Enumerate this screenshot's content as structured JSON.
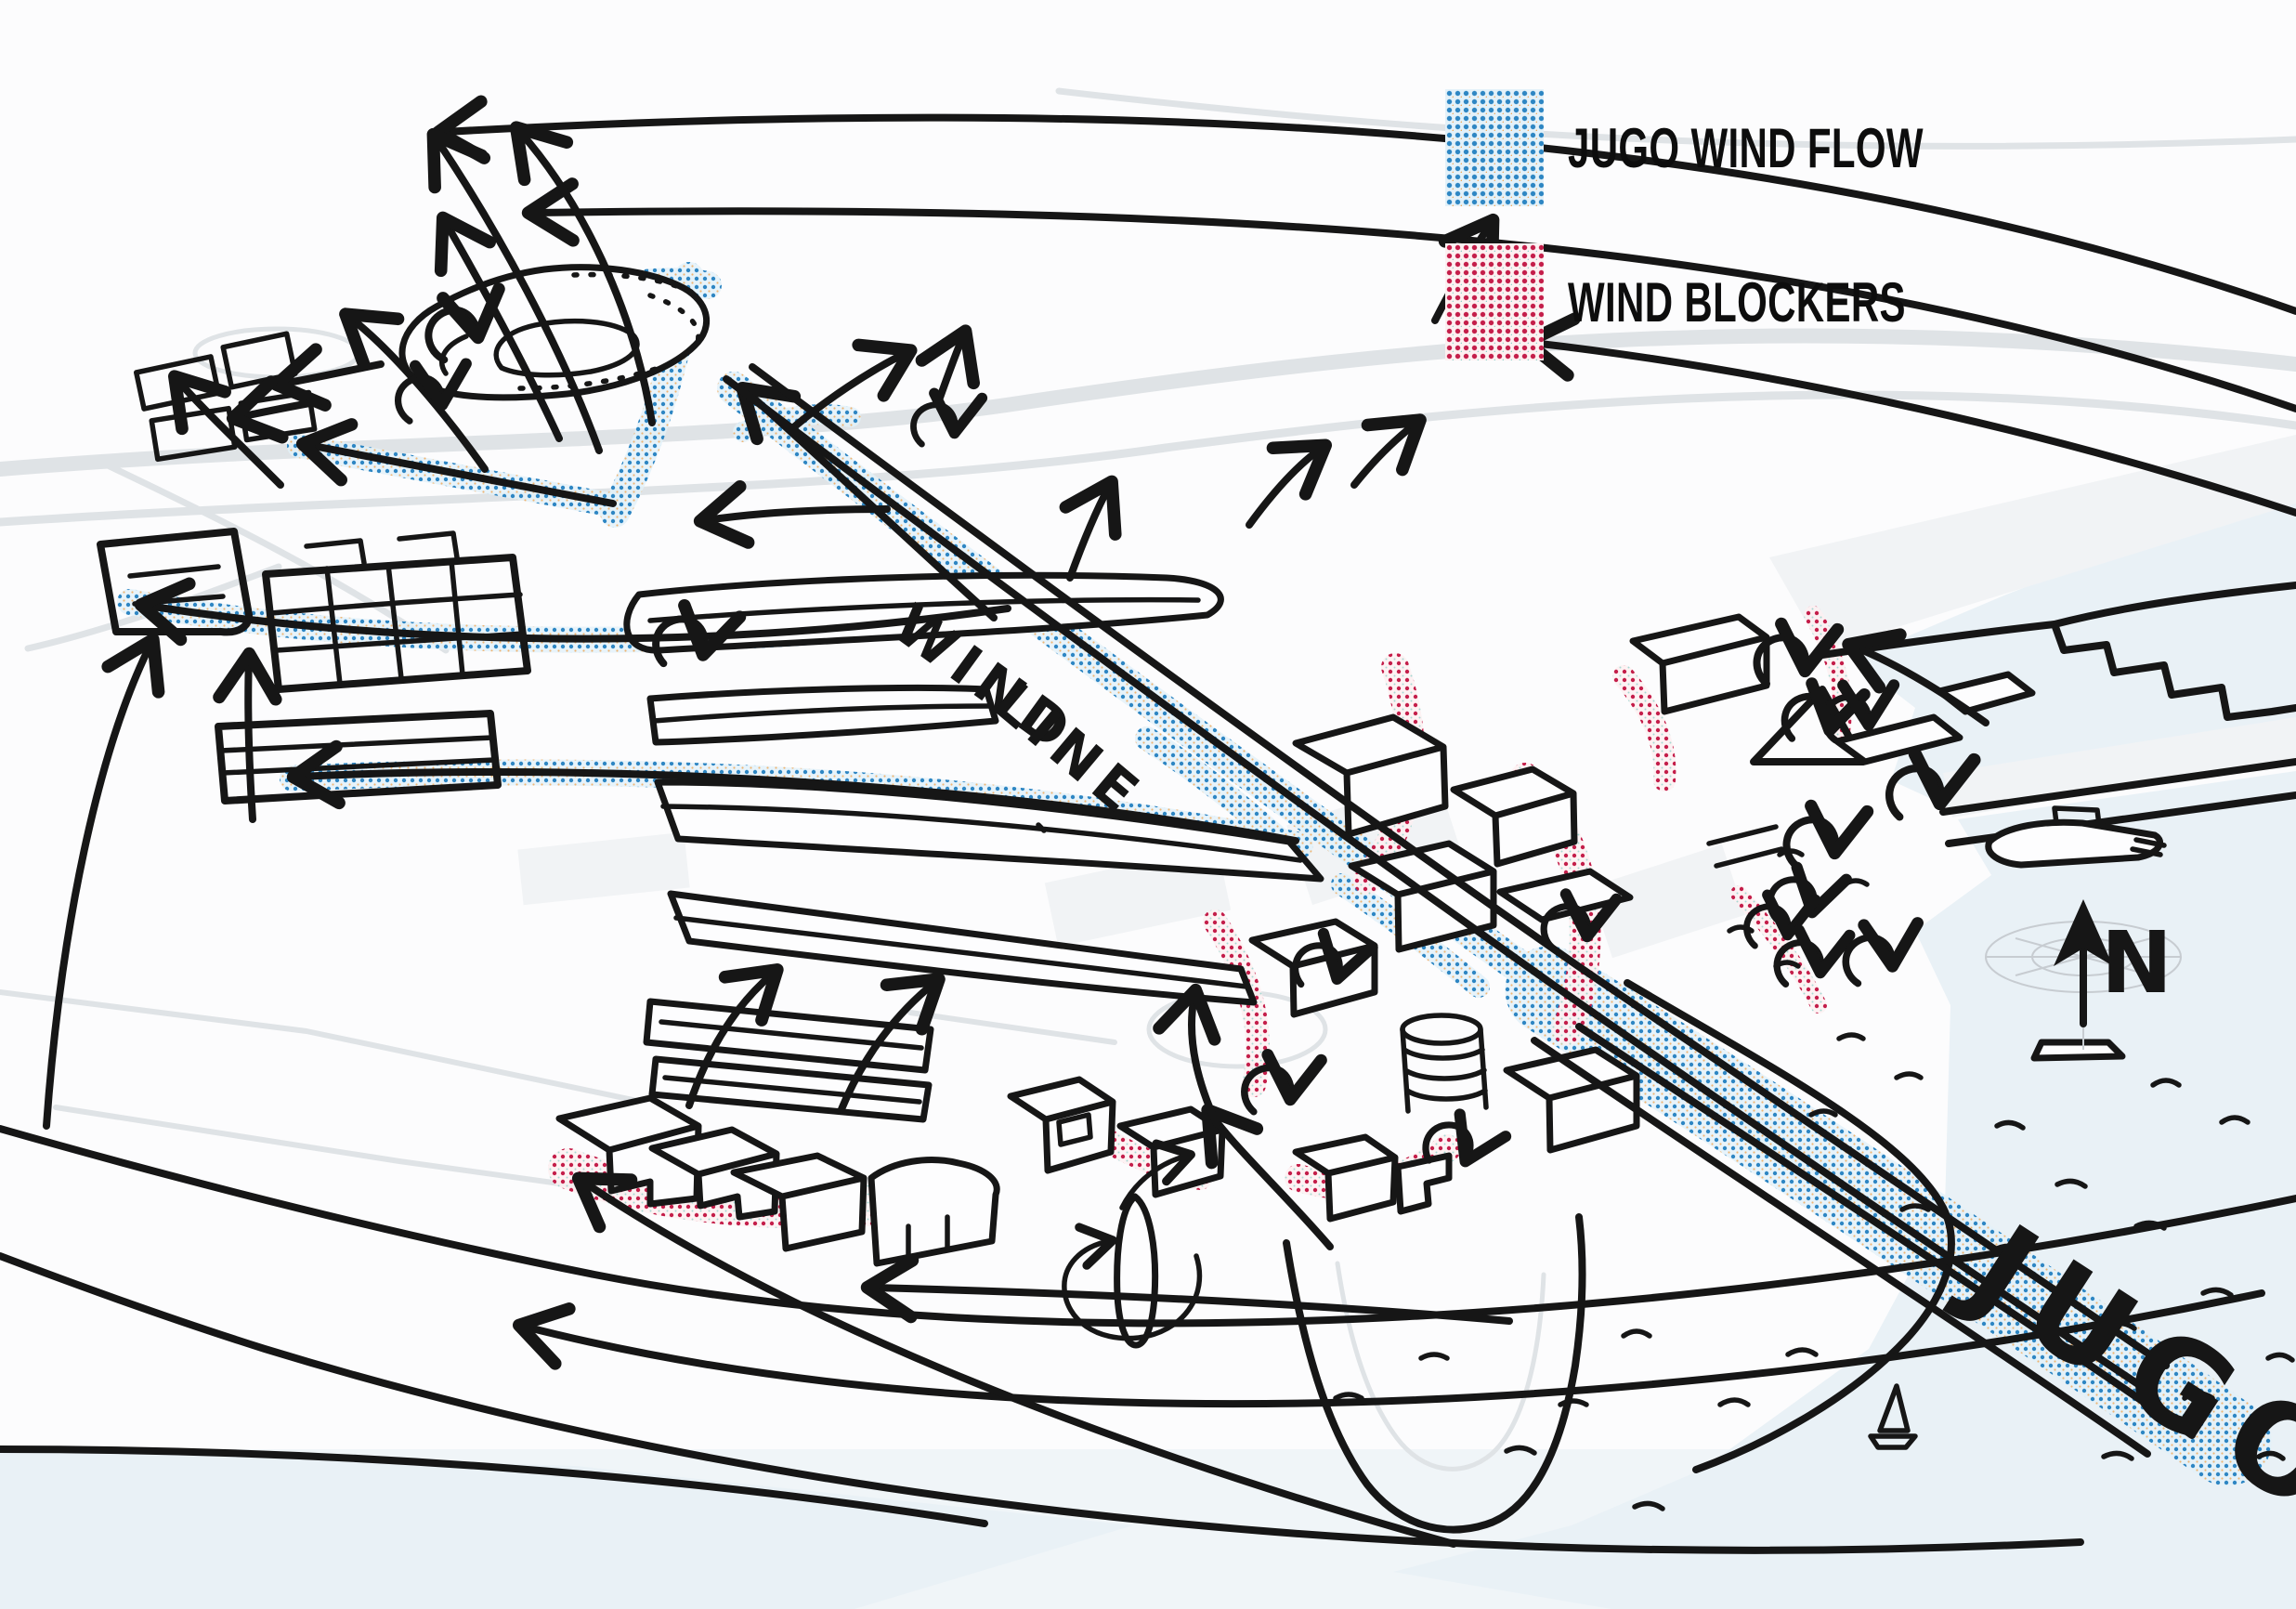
{
  "legend": {
    "items": [
      {
        "id": "jugo-wind-flow",
        "label": "JUGO WIND FLOW",
        "swatch_color": "#2e86c3",
        "swatch_style": "halftone-dots"
      },
      {
        "id": "wind-blockers",
        "label": "WIND BLOCKERS",
        "swatch_color": "#c41e4a",
        "swatch_style": "halftone-dots"
      }
    ]
  },
  "annotations": {
    "wind_line_words": [
      "WIND",
      "LINE"
    ],
    "jugo_label": "JUGO",
    "compass_north": "N"
  },
  "colors": {
    "ink": "#161616",
    "wind_blue": "#2e86c3",
    "wind_blue_bg": "#e3f1f9",
    "blocker_red": "#c41e4a",
    "blocker_red_bg": "#fdf0f1",
    "halftone_orange": "#f0a95c",
    "halftone_teal": "#8fd2cb",
    "sea": "#e9f1f6",
    "model_line": "#dfe3e6",
    "paper": "#fcfcfd"
  }
}
